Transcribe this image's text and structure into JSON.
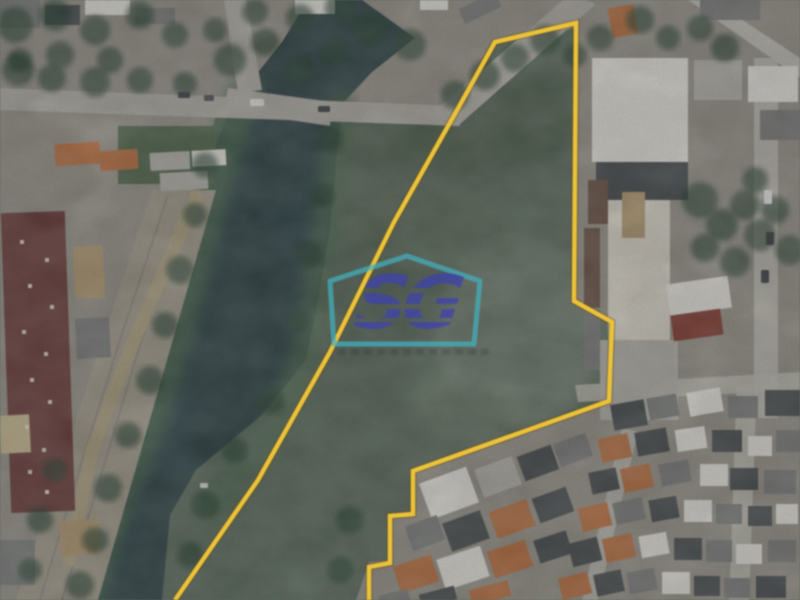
{
  "watermark": {
    "letters": "SG",
    "outline_color": "#39b4c6",
    "letter_color": "#3c40bb"
  },
  "boundary": {
    "color": "#f2c32c",
    "shadow_color": "rgba(95,70,8,0.4)",
    "points": "175,600 258,480 330,352 394,222 456,112 495,42 576,23 574,301 612,322 609,401 413,471 413,514 390,516 390,563 369,567 369,600"
  },
  "palette": {
    "base": "#5a6c5c",
    "water": "#2c4347",
    "waterlight": "#3d5a58",
    "urbanbase": "#98948a",
    "road": "#b2aea6",
    "roadlight": "#c2beb5",
    "corridor": "#a39c8c",
    "dirt": "#b3a47f",
    "rail": "#88847a",
    "bank": "#4a6a4e",
    "field": "#50684c",
    "tree": "#24402e",
    "orange": "#c0703c",
    "darkgray": "#474c4f",
    "gray": "#7b7e7c",
    "white": "#e9e7e0",
    "lightgray": "#b5b3ab",
    "maroon": "#6e3c3a",
    "tanroof": "#b59a6e",
    "brown": "#6b5244",
    "redroof": "#8a3c30",
    "cream": "#ded9cc",
    "tanlight": "#c9b98f"
  },
  "scene": {
    "houses": [
      [
        0,
        0,
        40,
        28,
        0,
        "gray"
      ],
      [
        45,
        5,
        35,
        20,
        0,
        "darkgray"
      ],
      [
        85,
        0,
        45,
        15,
        0,
        "white"
      ],
      [
        135,
        8,
        40,
        16,
        0,
        "gray"
      ],
      [
        295,
        0,
        40,
        14,
        0,
        "white"
      ],
      [
        420,
        0,
        28,
        10,
        0,
        "white"
      ],
      [
        460,
        0,
        40,
        16,
        -25,
        "gray"
      ],
      [
        55,
        143,
        45,
        22,
        -4,
        "orange"
      ],
      [
        100,
        150,
        38,
        20,
        -4,
        "orange"
      ],
      [
        150,
        152,
        40,
        18,
        -3,
        "lightgray"
      ],
      [
        192,
        150,
        34,
        16,
        -3,
        "white"
      ],
      [
        160,
        172,
        48,
        18,
        -3,
        "lightgray"
      ],
      [
        6,
        212,
        64,
        300,
        -2,
        "maroon"
      ],
      [
        74,
        246,
        30,
        52,
        -3,
        "tanroof"
      ],
      [
        76,
        318,
        34,
        40,
        -3,
        "gray"
      ],
      [
        60,
        520,
        40,
        35,
        -4,
        "tanroof"
      ],
      [
        0,
        540,
        35,
        45,
        0,
        "gray"
      ],
      [
        0,
        415,
        30,
        38,
        -3,
        "tanlight"
      ],
      [
        610,
        6,
        26,
        30,
        -10,
        "orange"
      ],
      [
        700,
        0,
        60,
        20,
        0,
        "gray"
      ],
      [
        694,
        60,
        48,
        40,
        0,
        "lightgray"
      ],
      [
        748,
        66,
        50,
        36,
        0,
        "white"
      ],
      [
        760,
        110,
        40,
        30,
        0,
        "gray"
      ],
      [
        592,
        58,
        96,
        104,
        0,
        "white"
      ],
      [
        596,
        162,
        92,
        38,
        0,
        "darkgray"
      ],
      [
        608,
        200,
        62,
        140,
        0,
        "cream"
      ],
      [
        622,
        192,
        23,
        46,
        0,
        "tanroof"
      ],
      [
        588,
        180,
        20,
        44,
        0,
        "brown"
      ],
      [
        584,
        228,
        16,
        80,
        0,
        "brown"
      ],
      [
        584,
        310,
        16,
        60,
        0,
        "gray"
      ],
      [
        600,
        340,
        78,
        80,
        0,
        "lightgray"
      ],
      [
        668,
        280,
        62,
        32,
        -8,
        "white"
      ],
      [
        672,
        312,
        50,
        26,
        -8,
        "redroof"
      ],
      [
        612,
        402,
        34,
        26,
        -10,
        "darkgray"
      ],
      [
        648,
        396,
        30,
        22,
        -10,
        "gray"
      ],
      [
        688,
        390,
        34,
        24,
        -10,
        "white"
      ],
      [
        728,
        396,
        30,
        22,
        0,
        "gray"
      ],
      [
        765,
        390,
        35,
        26,
        0,
        "darkgray"
      ],
      [
        600,
        436,
        30,
        24,
        -12,
        "orange"
      ],
      [
        636,
        430,
        32,
        24,
        -10,
        "darkgray"
      ],
      [
        676,
        428,
        30,
        22,
        -8,
        "white"
      ],
      [
        712,
        430,
        30,
        22,
        0,
        "darkgray"
      ],
      [
        748,
        436,
        24,
        20,
        0,
        "white"
      ],
      [
        776,
        430,
        24,
        22,
        0,
        "gray"
      ],
      [
        590,
        470,
        28,
        22,
        -12,
        "darkgray"
      ],
      [
        622,
        466,
        30,
        24,
        -12,
        "orange"
      ],
      [
        660,
        462,
        30,
        22,
        -10,
        "gray"
      ],
      [
        700,
        464,
        28,
        22,
        0,
        "white"
      ],
      [
        730,
        468,
        28,
        22,
        0,
        "darkgray"
      ],
      [
        764,
        470,
        32,
        24,
        0,
        "gray"
      ],
      [
        580,
        505,
        30,
        24,
        -14,
        "orange"
      ],
      [
        614,
        500,
        30,
        22,
        -12,
        "gray"
      ],
      [
        650,
        498,
        28,
        22,
        -10,
        "darkgray"
      ],
      [
        684,
        500,
        28,
        22,
        0,
        "white"
      ],
      [
        716,
        504,
        26,
        20,
        0,
        "gray"
      ],
      [
        748,
        506,
        24,
        20,
        0,
        "darkgray"
      ],
      [
        776,
        504,
        22,
        20,
        0,
        "white"
      ],
      [
        570,
        540,
        30,
        24,
        -14,
        "darkgray"
      ],
      [
        604,
        536,
        30,
        24,
        -12,
        "orange"
      ],
      [
        640,
        534,
        28,
        22,
        -10,
        "white"
      ],
      [
        674,
        538,
        28,
        22,
        0,
        "darkgray"
      ],
      [
        706,
        540,
        26,
        22,
        0,
        "gray"
      ],
      [
        736,
        544,
        26,
        20,
        0,
        "white"
      ],
      [
        768,
        540,
        28,
        22,
        0,
        "gray"
      ],
      [
        560,
        575,
        30,
        22,
        -14,
        "orange"
      ],
      [
        595,
        572,
        28,
        22,
        -12,
        "darkgray"
      ],
      [
        628,
        570,
        28,
        22,
        -10,
        "gray"
      ],
      [
        662,
        572,
        28,
        22,
        0,
        "white"
      ],
      [
        694,
        576,
        26,
        20,
        0,
        "darkgray"
      ],
      [
        724,
        578,
        26,
        20,
        0,
        "gray"
      ],
      [
        756,
        576,
        30,
        22,
        0,
        "darkgray"
      ],
      [
        424,
        474,
        50,
        38,
        -20,
        "white"
      ],
      [
        478,
        462,
        40,
        30,
        -20,
        "lightgray"
      ],
      [
        520,
        450,
        36,
        26,
        -20,
        "darkgray"
      ],
      [
        556,
        438,
        34,
        24,
        -20,
        "gray"
      ],
      [
        408,
        520,
        34,
        26,
        -20,
        "gray"
      ],
      [
        446,
        516,
        40,
        30,
        -20,
        "darkgray"
      ],
      [
        492,
        505,
        40,
        28,
        -20,
        "orange"
      ],
      [
        535,
        492,
        36,
        26,
        -20,
        "darkgray"
      ],
      [
        396,
        560,
        40,
        28,
        -18,
        "orange"
      ],
      [
        440,
        552,
        46,
        32,
        -18,
        "white"
      ],
      [
        490,
        545,
        40,
        28,
        -18,
        "orange"
      ],
      [
        536,
        535,
        34,
        24,
        -18,
        "darkgray"
      ],
      [
        380,
        592,
        30,
        16,
        -15,
        "gray"
      ],
      [
        420,
        590,
        36,
        14,
        -15,
        "darkgray"
      ],
      [
        470,
        585,
        40,
        16,
        -15,
        "orange"
      ]
    ],
    "roof_dots": [
      [
        20,
        240
      ],
      [
        45,
        258
      ],
      [
        28,
        284
      ],
      [
        50,
        305
      ],
      [
        22,
        330
      ],
      [
        44,
        352
      ],
      [
        30,
        378
      ],
      [
        48,
        400
      ],
      [
        25,
        425
      ],
      [
        42,
        448
      ],
      [
        28,
        470
      ],
      [
        45,
        490
      ]
    ],
    "trees": [
      [
        15,
        25,
        18
      ],
      [
        55,
        15,
        16
      ],
      [
        95,
        30,
        15
      ],
      [
        140,
        15,
        14
      ],
      [
        175,
        35,
        13
      ],
      [
        60,
        55,
        14
      ],
      [
        110,
        60,
        13
      ],
      [
        20,
        60,
        12
      ],
      [
        18,
        70,
        16
      ],
      [
        52,
        78,
        14
      ],
      [
        95,
        82,
        15
      ],
      [
        140,
        80,
        13
      ],
      [
        185,
        84,
        12
      ],
      [
        230,
        60,
        16
      ],
      [
        265,
        42,
        14
      ],
      [
        300,
        70,
        15
      ],
      [
        335,
        52,
        16
      ],
      [
        370,
        30,
        18
      ],
      [
        410,
        45,
        16
      ],
      [
        300,
        18,
        14
      ],
      [
        340,
        8,
        15
      ],
      [
        255,
        12,
        13
      ],
      [
        215,
        30,
        12
      ],
      [
        455,
        95,
        14
      ],
      [
        485,
        75,
        15
      ],
      [
        515,
        58,
        14
      ],
      [
        545,
        40,
        15
      ],
      [
        575,
        55,
        12
      ],
      [
        600,
        38,
        13
      ],
      [
        640,
        20,
        14
      ],
      [
        668,
        38,
        12
      ],
      [
        700,
        28,
        13
      ],
      [
        725,
        48,
        14
      ],
      [
        700,
        200,
        18
      ],
      [
        722,
        225,
        16
      ],
      [
        745,
        205,
        15
      ],
      [
        760,
        235,
        16
      ],
      [
        735,
        262,
        15
      ],
      [
        705,
        248,
        14
      ],
      [
        775,
        210,
        14
      ],
      [
        790,
        250,
        15
      ],
      [
        755,
        180,
        13
      ],
      [
        205,
        165,
        13
      ],
      [
        195,
        215,
        12
      ],
      [
        180,
        270,
        14
      ],
      [
        165,
        325,
        13
      ],
      [
        150,
        380,
        14
      ],
      [
        128,
        435,
        13
      ],
      [
        108,
        488,
        14
      ],
      [
        95,
        540,
        13
      ],
      [
        80,
        585,
        14
      ],
      [
        330,
        140,
        13
      ],
      [
        322,
        195,
        12
      ],
      [
        310,
        255,
        13
      ],
      [
        298,
        320,
        12
      ],
      [
        270,
        400,
        14
      ],
      [
        235,
        450,
        13
      ],
      [
        205,
        505,
        14
      ],
      [
        190,
        555,
        13
      ],
      [
        55,
        470,
        12
      ],
      [
        40,
        520,
        13
      ],
      [
        30,
        570,
        12
      ],
      [
        350,
        520,
        14
      ],
      [
        340,
        570,
        13
      ]
    ],
    "patches": [
      [
        460,
        120,
        115,
        60,
        "#42543f",
        0.45
      ],
      [
        520,
        330,
        85,
        95,
        "#8e9a8b",
        0.4
      ],
      [
        380,
        300,
        70,
        60,
        "#4c5e4e",
        0.35
      ],
      [
        470,
        420,
        60,
        40,
        "#6f7f6c",
        0.4
      ],
      [
        430,
        230,
        90,
        50,
        "#596b55",
        0.4
      ],
      [
        120,
        520,
        40,
        60,
        "#3a5856",
        0.5
      ],
      [
        310,
        150,
        18,
        50,
        "#3a5856",
        0.45
      ]
    ],
    "cars": [
      [
        250,
        99,
        14,
        7,
        "#e8e8e8"
      ],
      [
        178,
        92,
        12,
        6,
        "#333a3e"
      ],
      [
        204,
        95,
        10,
        6,
        "#4a5054"
      ],
      [
        318,
        106,
        12,
        6,
        "#2f3538"
      ],
      [
        764,
        190,
        8,
        14,
        "#e8e8e8"
      ],
      [
        766,
        232,
        8,
        13,
        "#30363a"
      ],
      [
        761,
        270,
        8,
        13,
        "#383e42"
      ],
      [
        200,
        483,
        8,
        5,
        "#dfe3e0"
      ]
    ]
  }
}
